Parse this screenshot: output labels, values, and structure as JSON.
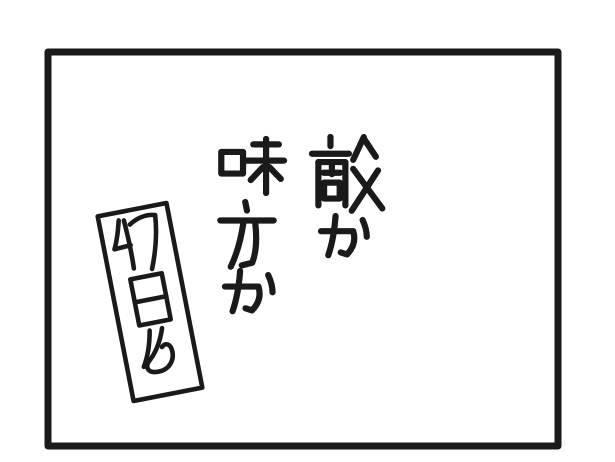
{
  "colors": {
    "ink": "#1a1a1a",
    "paper": "#ffffff"
  },
  "panel": {
    "captions": [
      {
        "position": "right-column",
        "text": "敵か"
      },
      {
        "position": "left-column",
        "text": "味方か"
      }
    ],
    "day_label": {
      "text": "47日め"
    }
  }
}
